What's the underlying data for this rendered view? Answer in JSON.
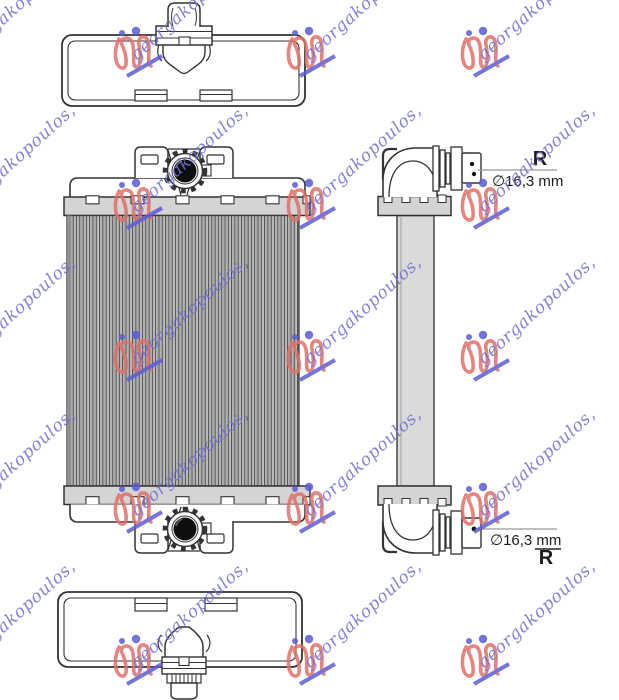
{
  "watermark": {
    "text": "georgakopoulos,",
    "text_color": "#7171d6",
    "logo_color": "#e0706a",
    "dot_color": "#5b5bd4",
    "underline_color": "#5c5cd6"
  },
  "drawing": {
    "line_color": "#333333",
    "plate_gray": "#d4d4d4",
    "column_gray": "#dadada",
    "cap_black": "#0f0f0f",
    "leader_gray": "#999999"
  },
  "annotations": {
    "top_port": {
      "r_label": "R",
      "diameter_label": "∅16,3 mm"
    },
    "bottom_port": {
      "diameter_label": "∅16,3 mm",
      "r_label": "R"
    }
  }
}
